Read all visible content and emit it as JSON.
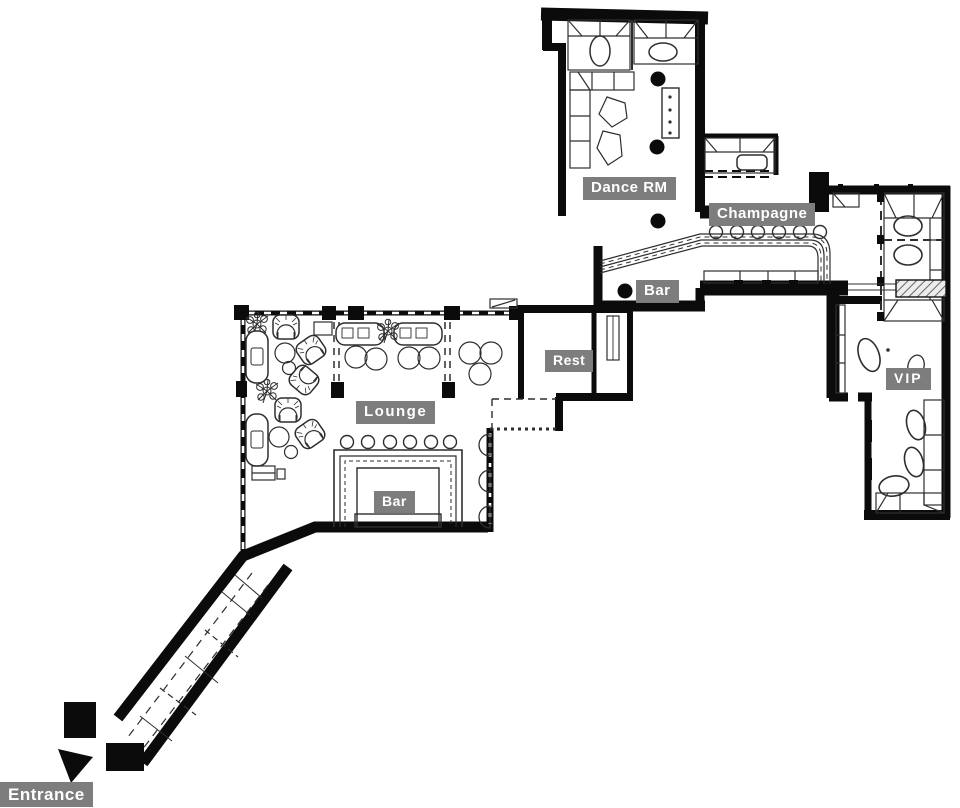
{
  "document": {
    "type": "floor-plan",
    "venue": "nightclub-lounge"
  },
  "colors": {
    "wall": "#0b0b0b",
    "furniture_line": "#2e2e2e",
    "label_bg": "#7d7d7d",
    "label_text": "#ffffff",
    "paper": "#ffffff"
  },
  "rooms": [
    {
      "id": "dance-rm",
      "label": "Dance RM"
    },
    {
      "id": "champagne",
      "label": "Champagne"
    },
    {
      "id": "bar-upper",
      "label": "Bar"
    },
    {
      "id": "rest",
      "label": "Rest"
    },
    {
      "id": "lounge",
      "label": "Lounge"
    },
    {
      "id": "bar-lounge",
      "label": "Bar"
    },
    {
      "id": "vip",
      "label": "VIP"
    },
    {
      "id": "entrance",
      "label": "Entrance"
    }
  ],
  "icons": {
    "entrance_arrow": "arrow pointing to entrance (south-west)"
  }
}
